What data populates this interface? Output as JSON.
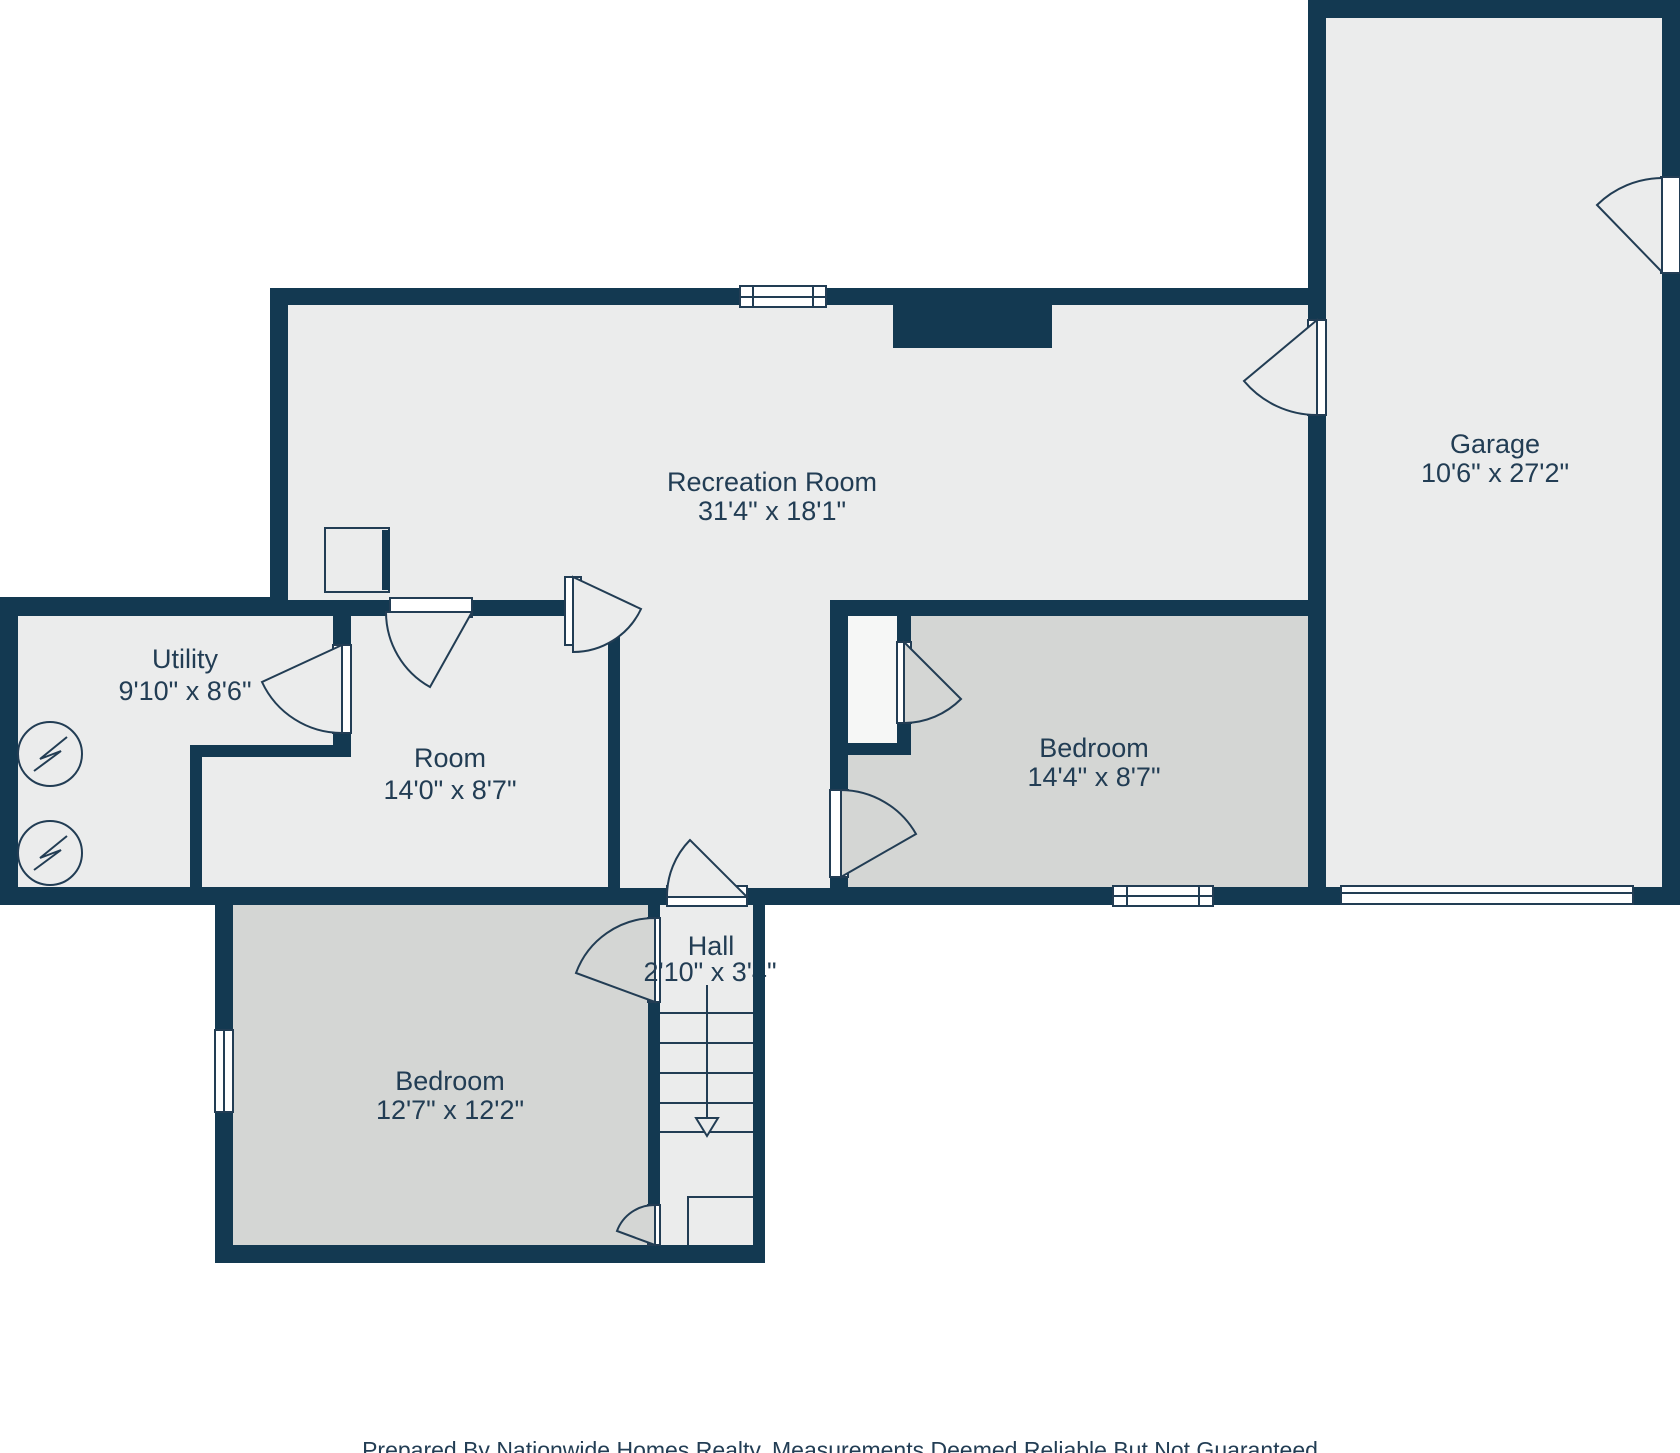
{
  "plan": {
    "title": "Basement floor plan",
    "rooms": [
      {
        "id": "recreation",
        "name": "Recreation Room",
        "dims": "31'4\" x 18'1\""
      },
      {
        "id": "garage",
        "name": "Garage",
        "dims": "10'6\" x 27'2\""
      },
      {
        "id": "utility",
        "name": "Utility",
        "dims": "9'10\" x 8'6\""
      },
      {
        "id": "room",
        "name": "Room",
        "dims": "14'0\" x 8'7\""
      },
      {
        "id": "bedroom_right",
        "name": "Bedroom",
        "dims": "14'4\" x 8'7\""
      },
      {
        "id": "hall",
        "name": "Hall",
        "dims": "2'10\" x 3'4\""
      },
      {
        "id": "bedroom_lower",
        "name": "Bedroom",
        "dims": "12'7\" x 12'2\""
      }
    ],
    "footer": "Prepared By Nationwide Homes Realty. Measurements Deemed Reliable But Not Guaranteed",
    "colors": {
      "wall": "#133951",
      "floor": "#ebecec",
      "bedroom_floor": "#d4d6d4",
      "closet_floor": "#f6f7f6",
      "line": "#223d54",
      "background": "#ffffff",
      "text": "#223d54"
    },
    "symbols": [
      "door-swing",
      "window",
      "stairs-down-arrow",
      "electrical-appliance",
      "chimney"
    ]
  }
}
